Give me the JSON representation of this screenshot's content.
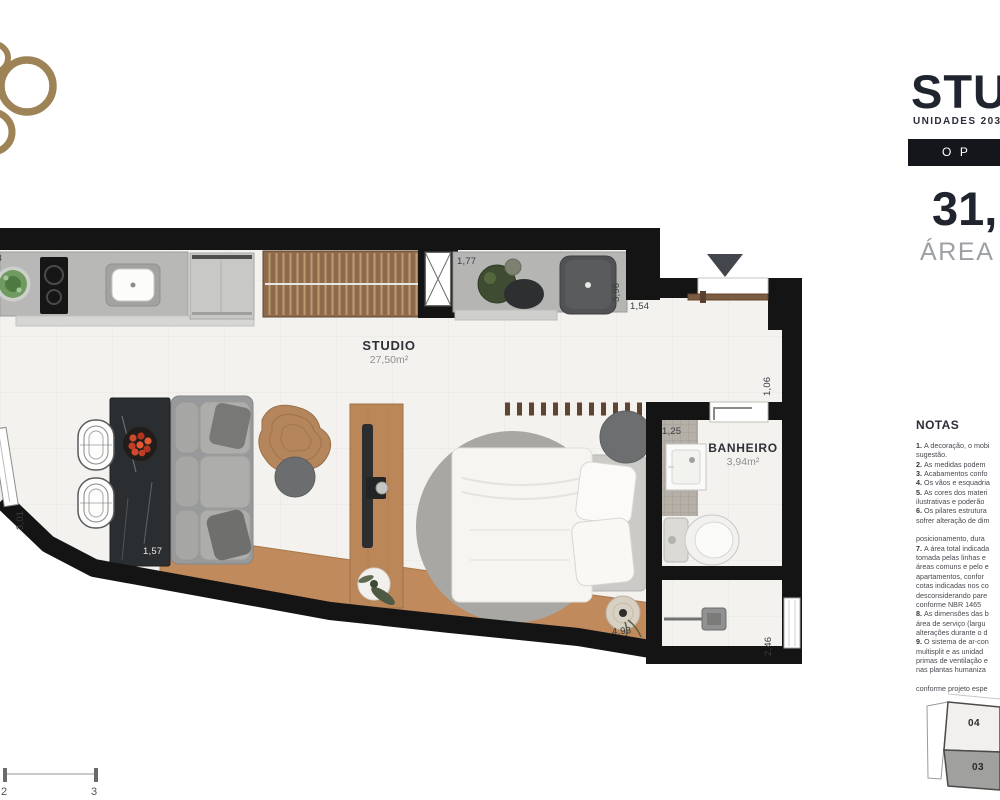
{
  "header": {
    "title": "STU",
    "subtitle": "UNIDADES 203",
    "banner": "O P",
    "area_value": "31,",
    "area_label": "ÁREA"
  },
  "plan": {
    "studio_label": "STUDIO",
    "studio_area": "27,50m²",
    "bathroom_label": "BANHEIRO",
    "bathroom_area": "3,94m²",
    "dims": {
      "counter_top": "1,77",
      "basin_side": "3,96",
      "entry_top": "1,54",
      "entry_side": "1,06",
      "bath_top": "1,25",
      "left_wall": "3,01",
      "table": "1,57",
      "bed_wall": "4,93",
      "shower_side": "2,46",
      "kitchen_edge": "43"
    }
  },
  "notes": {
    "heading": "NOTAS",
    "lines": [
      "1. A decoração, o mobi",
      "sugestão.",
      "2. As medidas podem",
      "3. Acabamentos confo",
      "4. Os vãos e esquadria",
      "5. As cores dos materi",
      "ilustrativas e poderão",
      "6. Os pilares estrutura",
      "sofrer alteração de dim",
      "",
      "posicionamento, dura",
      "7. A área total indicada",
      "tomada pelas linhas e",
      "áreas comuns e pelo e",
      "apartamentos, confor",
      "cotas indicadas nos co",
      "desconsiderando pare",
      "conforme NBR 1465",
      "8. As dimensões das b",
      "área de serviço (largu",
      "alterações durante o d",
      "9. O sistema de ar-con",
      "multisplit e as unidad",
      "primas de ventilação e",
      "nas plantas humaniza",
      "",
      "conforme projeto espe"
    ]
  },
  "scale_bar": {
    "ticks": [
      "2",
      "3"
    ]
  },
  "keyplan": {
    "units": [
      {
        "label": "04",
        "highlighted": false
      },
      {
        "label": "03",
        "highlighted": true
      }
    ]
  },
  "colors": {
    "accent_gold": "#9d8355",
    "wall_black": "#141414",
    "title_text": "#20242e",
    "muted_text": "#9da0a4",
    "wood": "#bb8759",
    "keyplan_highlight": "#a0a09e"
  }
}
